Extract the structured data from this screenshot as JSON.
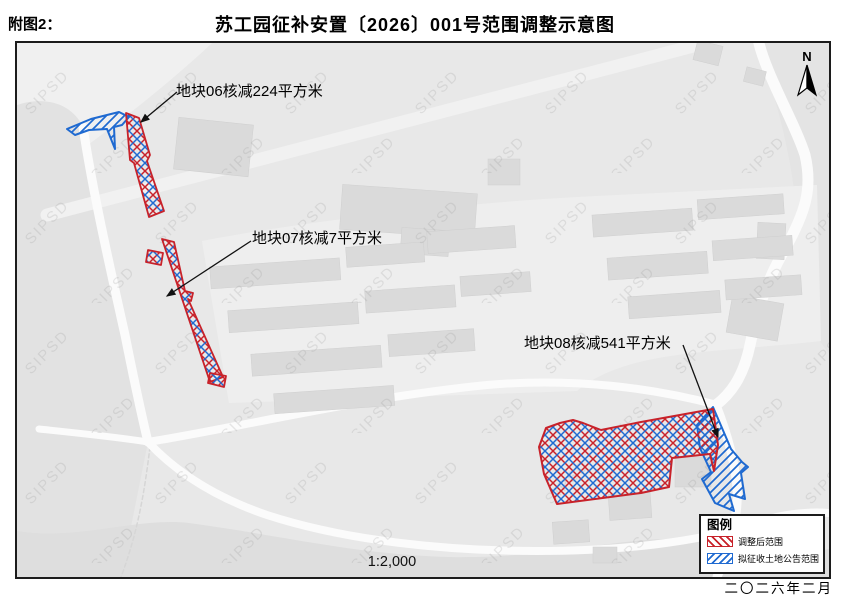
{
  "header": {
    "figure_label": "附图2：",
    "title": "苏工园征补安置〔2026〕001号范围调整示意图"
  },
  "map": {
    "north_label": "N",
    "scale_text": "1:2,000",
    "watermark": "SIPSD",
    "annotations": [
      {
        "id": "parcel-06",
        "label": "地块06核减224平方米"
      },
      {
        "id": "parcel-07",
        "label": "地块07核减7平方米"
      },
      {
        "id": "parcel-08",
        "label": "地块08核减541平方米"
      }
    ]
  },
  "legend": {
    "title": "图例",
    "items": [
      {
        "label": "调整后范围",
        "color": "#c8222a",
        "hatch": "red-backslash"
      },
      {
        "label": "拟征收土地公告范围",
        "color": "#1f6ad1",
        "hatch": "blue-slash"
      }
    ]
  },
  "footer": {
    "date_text": "二〇二六年二月"
  },
  "colors": {
    "adjusted_boundary": "#c8222a",
    "announced_boundary": "#1f6ad1",
    "map_background": "#e8e8e8",
    "road": "#fbfbfb",
    "building": "#dadada"
  }
}
